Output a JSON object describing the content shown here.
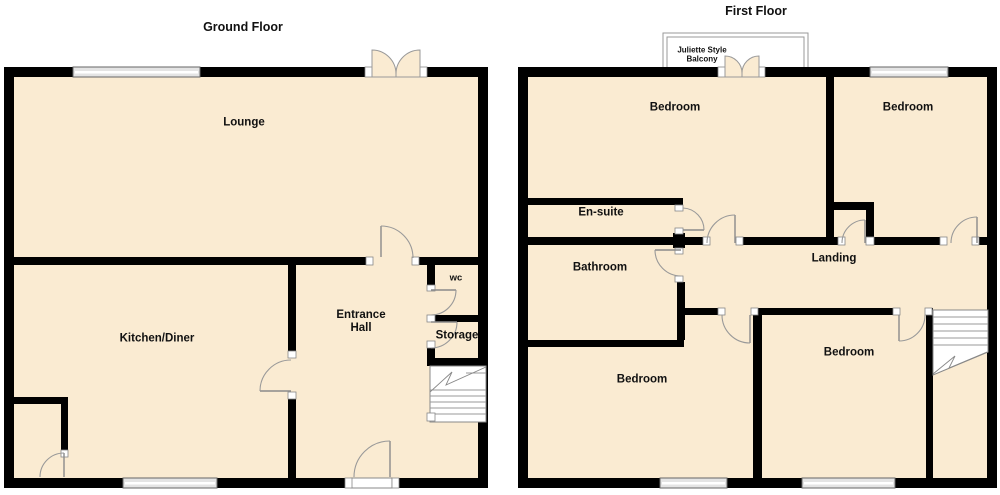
{
  "colors": {
    "background": "#FFFFFF",
    "floor": "#FAEBD2",
    "wall": "#000000",
    "door_swing": "#999999",
    "window_fill": "#E4E4E4"
  },
  "ground_floor": {
    "title": "Ground Floor",
    "rooms": {
      "lounge": "Lounge",
      "kitchen_diner": "Kitchen/Diner",
      "entrance_hall": "Entrance Hall",
      "wc": "wc",
      "storage": "Storage"
    }
  },
  "first_floor": {
    "title": "First Floor",
    "rooms": {
      "bedroom_top_left": "Bedroom",
      "bedroom_top_right": "Bedroom",
      "en_suite": "En-suite",
      "bathroom": "Bathroom",
      "landing": "Landing",
      "bedroom_bottom_left": "Bedroom",
      "bedroom_bottom_right": "Bedroom",
      "balcony": "Juliette Style Balcony"
    }
  }
}
